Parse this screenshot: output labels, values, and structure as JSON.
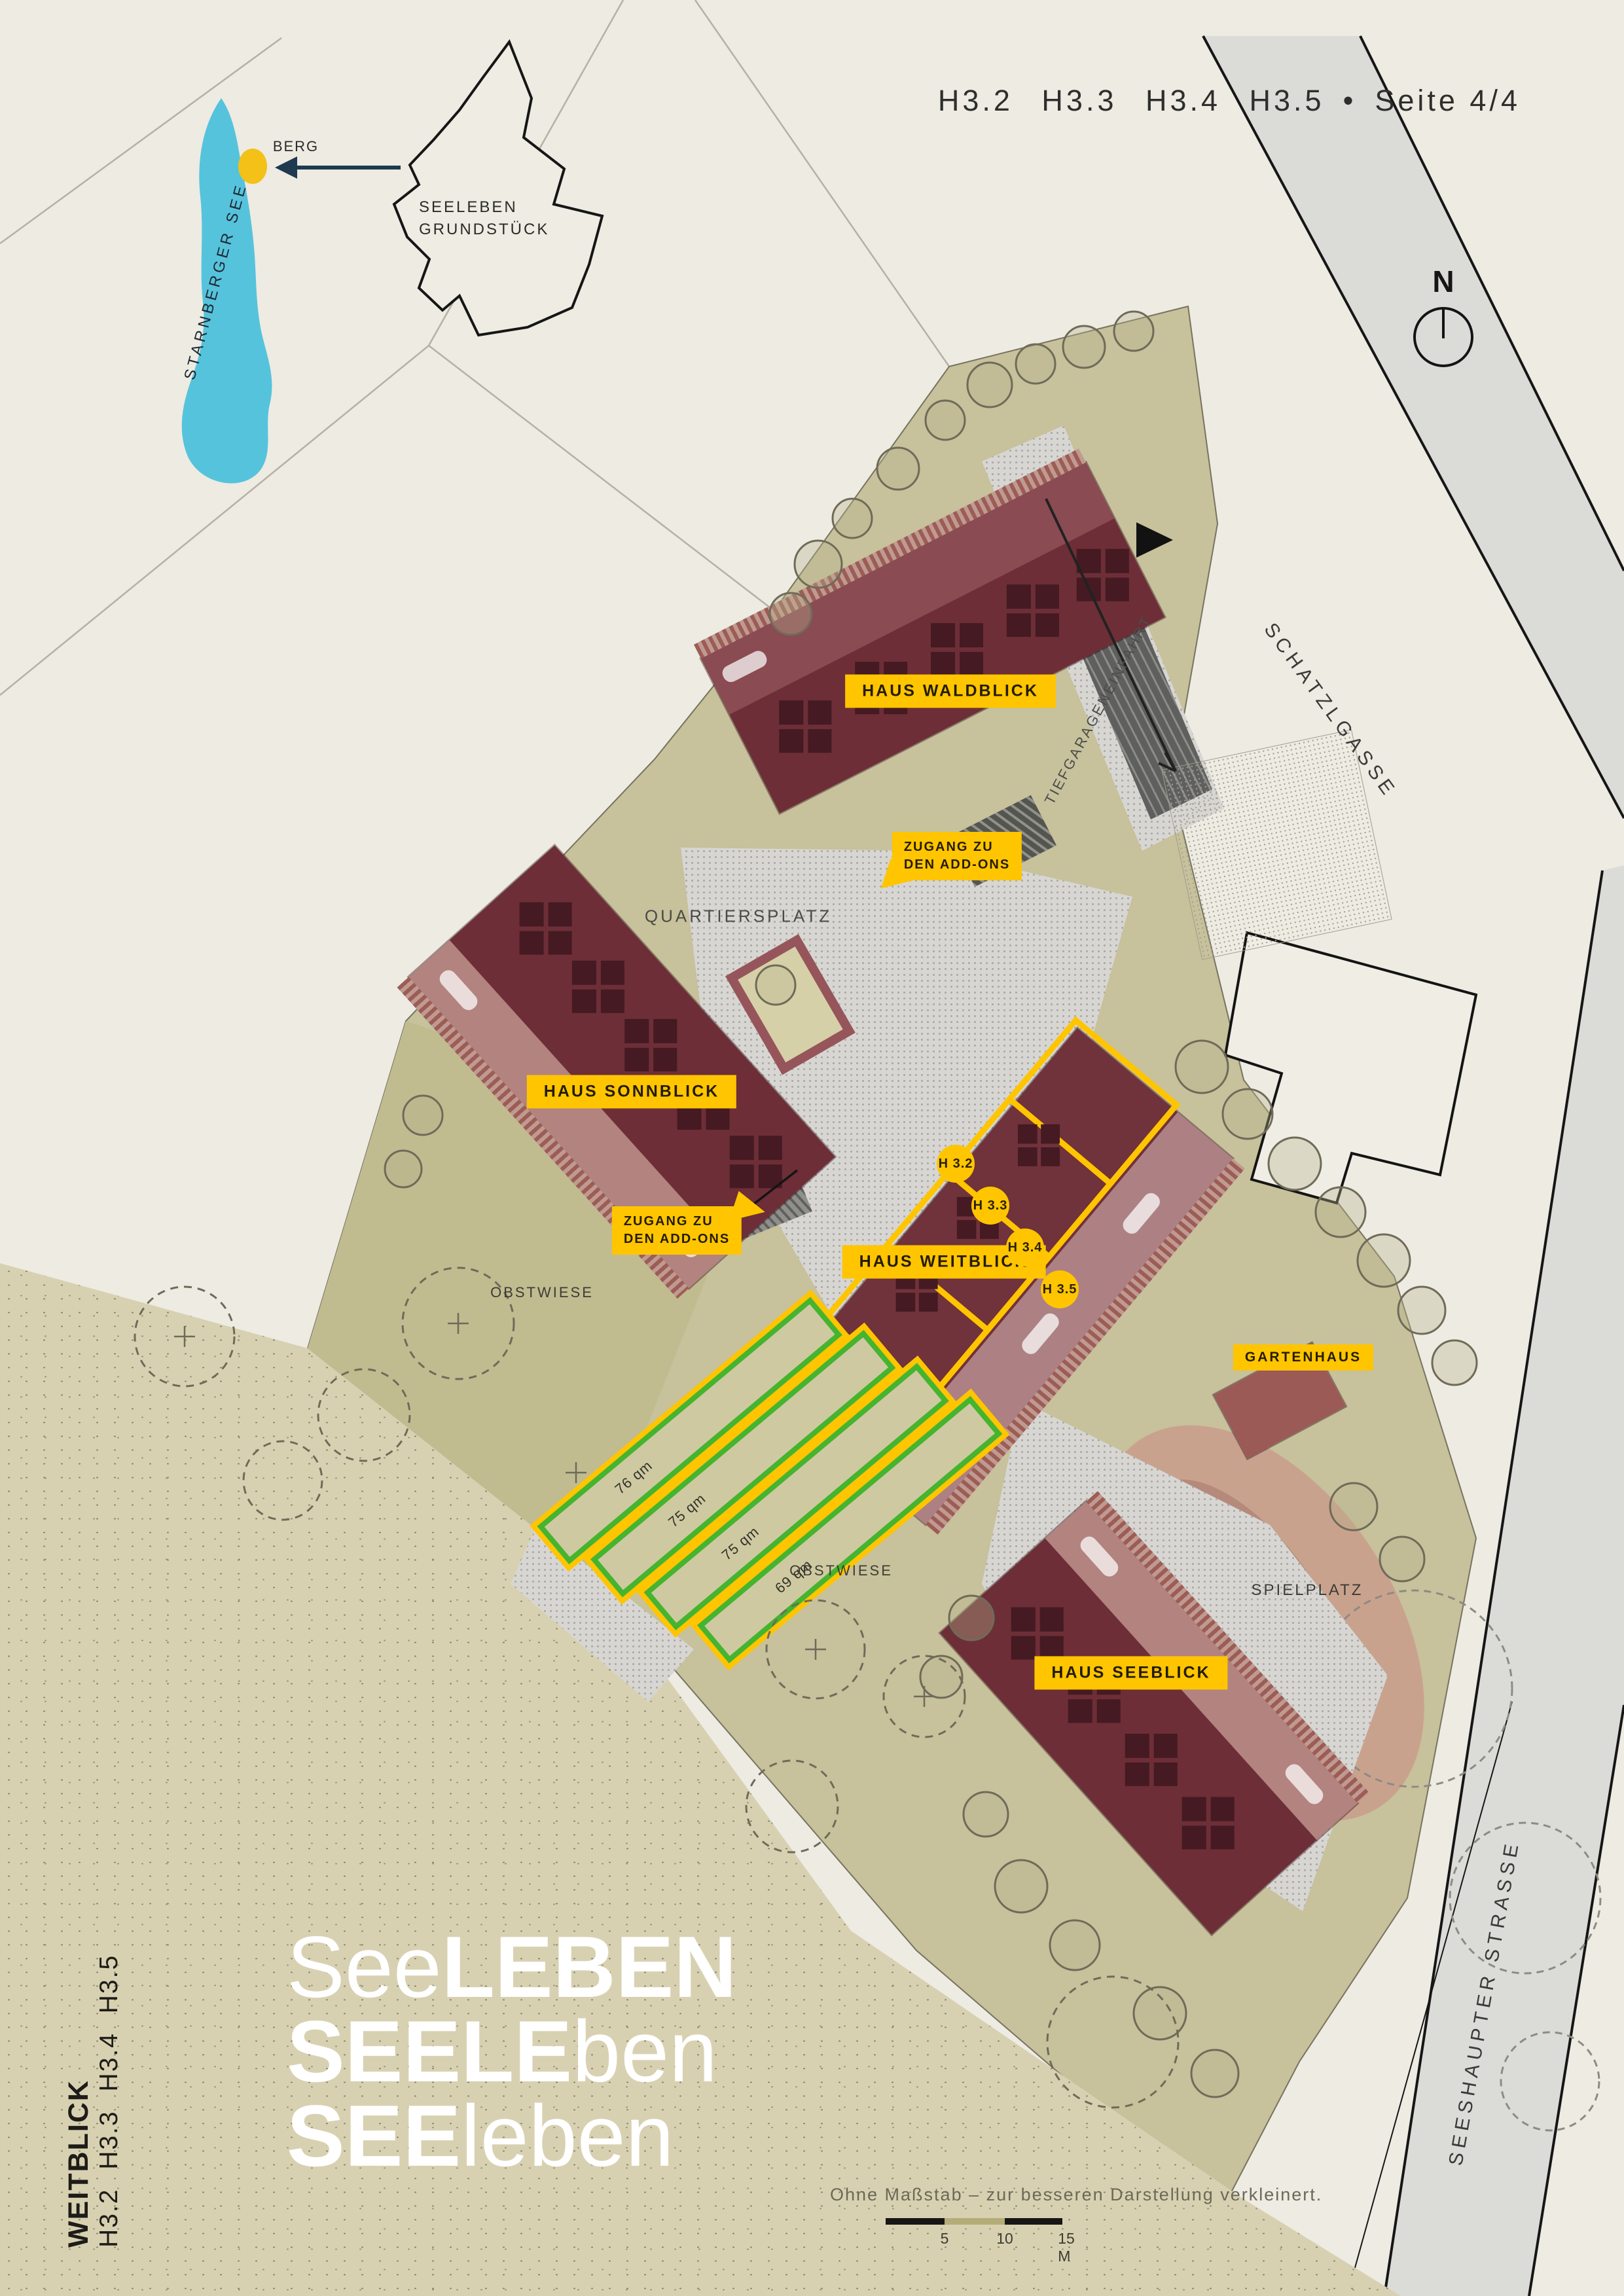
{
  "header": {
    "houses": "H3.2 H3.3 H3.4 H3.5",
    "bullet": "•",
    "page": "Seite 4/4"
  },
  "compass": {
    "north": "N"
  },
  "inset": {
    "lake": "STARNBERGER SEE",
    "marker": "BERG",
    "site_line1": "SEELEBEN",
    "site_line2": "GRUNDSTÜCK"
  },
  "streets": {
    "north_road": "SCHATZLGASSE",
    "east_road": "SEESHAUPTER STRASSE",
    "garage_ramp": "TIEFGARAGENEINFAHRT"
  },
  "places": {
    "plaza": "QUARTIERSPLATZ",
    "orchard_west": "OBSTWIESE",
    "orchard_south": "OBSTWIESE",
    "playground": "SPIELPLATZ"
  },
  "buildings": {
    "waldblick": "HAUS WALDBLICK",
    "sonnblick": "HAUS SONNBLICK",
    "weitblick": "HAUS WEITBLICK",
    "seeblick": "HAUS SEEBLICK",
    "gartenhaus": "GARTENHAUS"
  },
  "access_labels": {
    "line1": "ZUGANG ZU",
    "line2": "DEN ADD-ONS"
  },
  "units": [
    {
      "label": "H 3.2"
    },
    {
      "label": "H 3.3"
    },
    {
      "label": "H 3.4"
    },
    {
      "label": "H 3.5"
    }
  ],
  "garden_plots": [
    {
      "area": "76 qm"
    },
    {
      "area": "75 qm"
    },
    {
      "area": "75 qm"
    },
    {
      "area": "69 qm"
    }
  ],
  "brand": {
    "line1_light": "See",
    "line1_bold": "LEBEN",
    "line2_bold": "SEELE",
    "line2_light": "ben",
    "line3_bold": "SEE",
    "line3_light": "leben"
  },
  "sidebar": {
    "title": "WEITBLICK",
    "subtitle": "H3.2 H3.3 H3.4 H3.5"
  },
  "footnote": {
    "text": "Ohne Maßstab – zur besseren Darstellung verkleinert.",
    "scale_ticks": [
      "5",
      "10",
      "15 M"
    ]
  },
  "colors": {
    "accent_yellow": "#ffc500",
    "plot_green": "#45b42e",
    "lake_blue": "#56c3dc",
    "building_maroon": "#6d2e37",
    "arrow_navy": "#1d3a50"
  }
}
